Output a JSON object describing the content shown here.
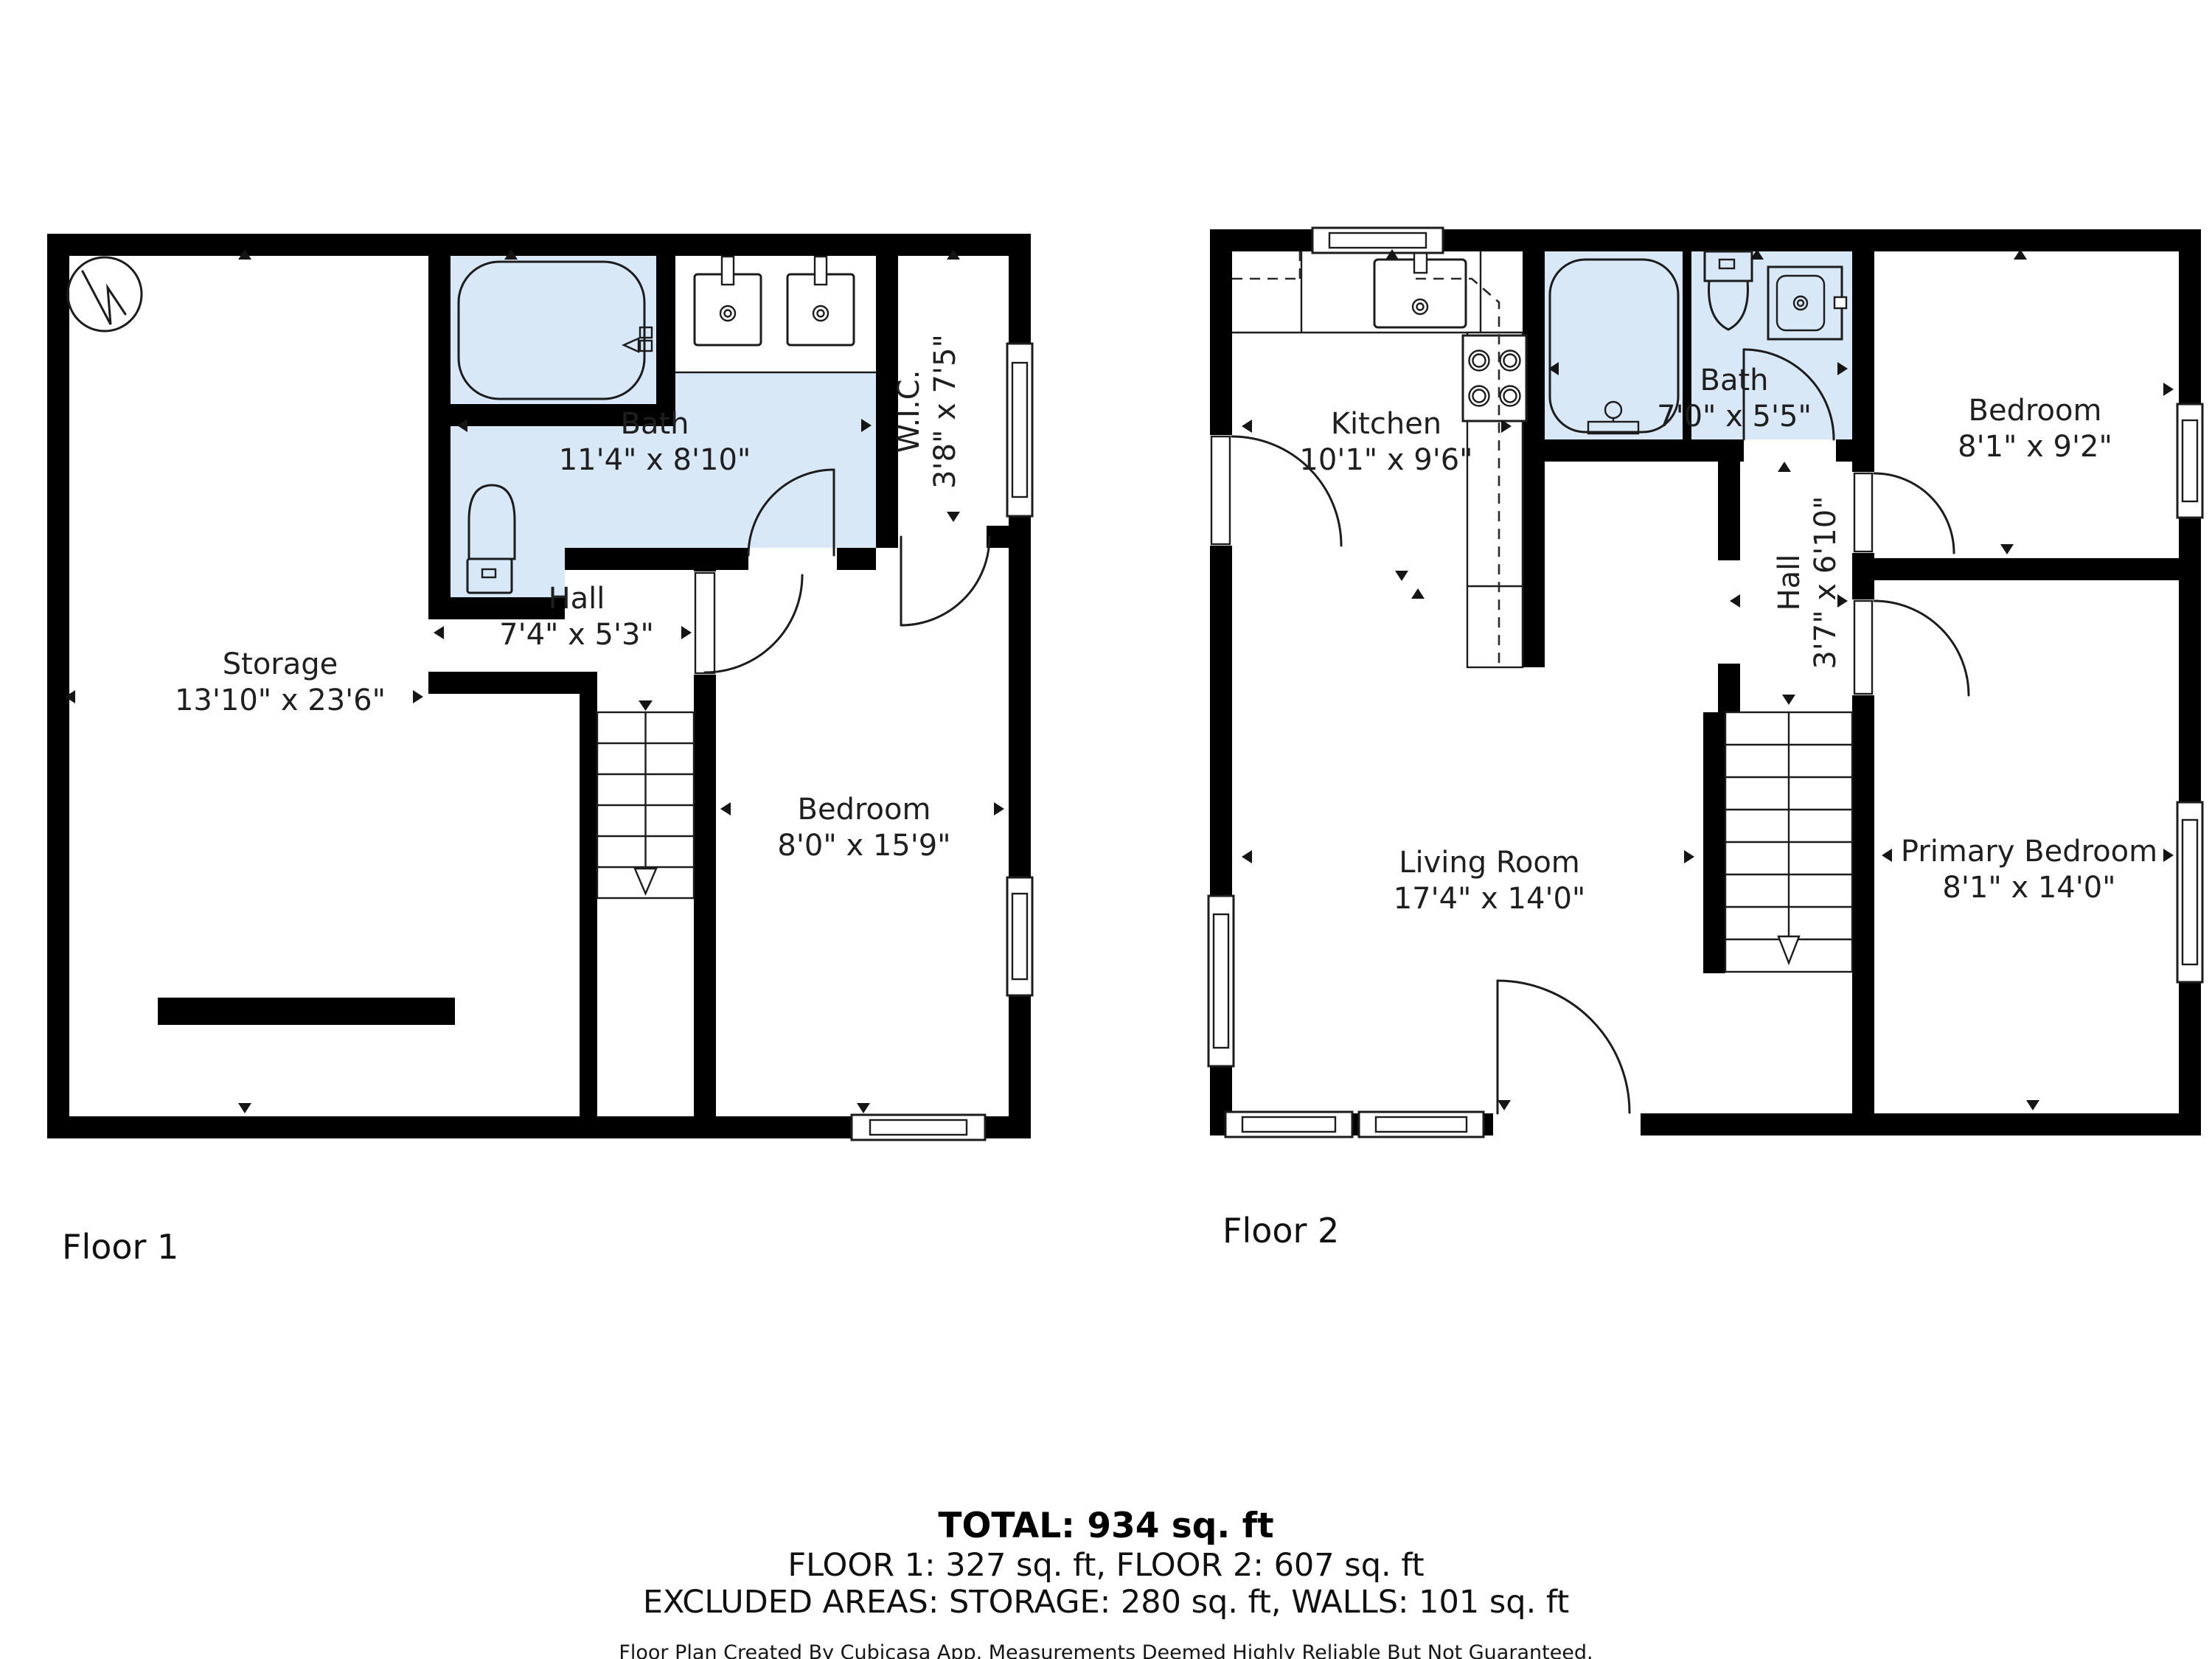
{
  "floor1": {
    "label": "Floor 1",
    "rooms": {
      "storage": {
        "name": "Storage",
        "dims": "13'10\" x 23'6\""
      },
      "bath": {
        "name": "Bath",
        "dims": "11'4\" x 8'10\""
      },
      "wic": {
        "name": "W.I.C.",
        "dims": "3'8\" x 7'5\""
      },
      "hall": {
        "name": "Hall",
        "dims": "7'4\" x 5'3\""
      },
      "bedroom": {
        "name": "Bedroom",
        "dims": "8'0\" x 15'9\""
      }
    }
  },
  "floor2": {
    "label": "Floor 2",
    "rooms": {
      "kitchen": {
        "name": "Kitchen",
        "dims": "10'1\" x 9'6\""
      },
      "bath": {
        "name": "Bath",
        "dims": "7'0\" x 5'5\""
      },
      "bedroom": {
        "name": "Bedroom",
        "dims": "8'1\" x 9'2\""
      },
      "hall": {
        "name": "Hall",
        "dims": "3'7\" x 6'10\""
      },
      "living": {
        "name": "Living Room",
        "dims": "17'4\" x 14'0\""
      },
      "primary": {
        "name": "Primary Bedroom",
        "dims": "8'1\" x 14'0\""
      }
    }
  },
  "summary": {
    "total": "TOTAL: 934 sq. ft",
    "floors": "FLOOR 1: 327 sq. ft, FLOOR 2: 607 sq. ft",
    "excluded": "EXCLUDED AREAS: STORAGE: 280 sq. ft, WALLS: 101 sq. ft",
    "disclaimer": "Floor Plan Created By Cubicasa App. Measurements Deemed Highly Reliable But Not Guaranteed."
  },
  "colors": {
    "wall": "#000000",
    "bath_fill": "#d8e8f6",
    "text": "#1f1f1f"
  }
}
